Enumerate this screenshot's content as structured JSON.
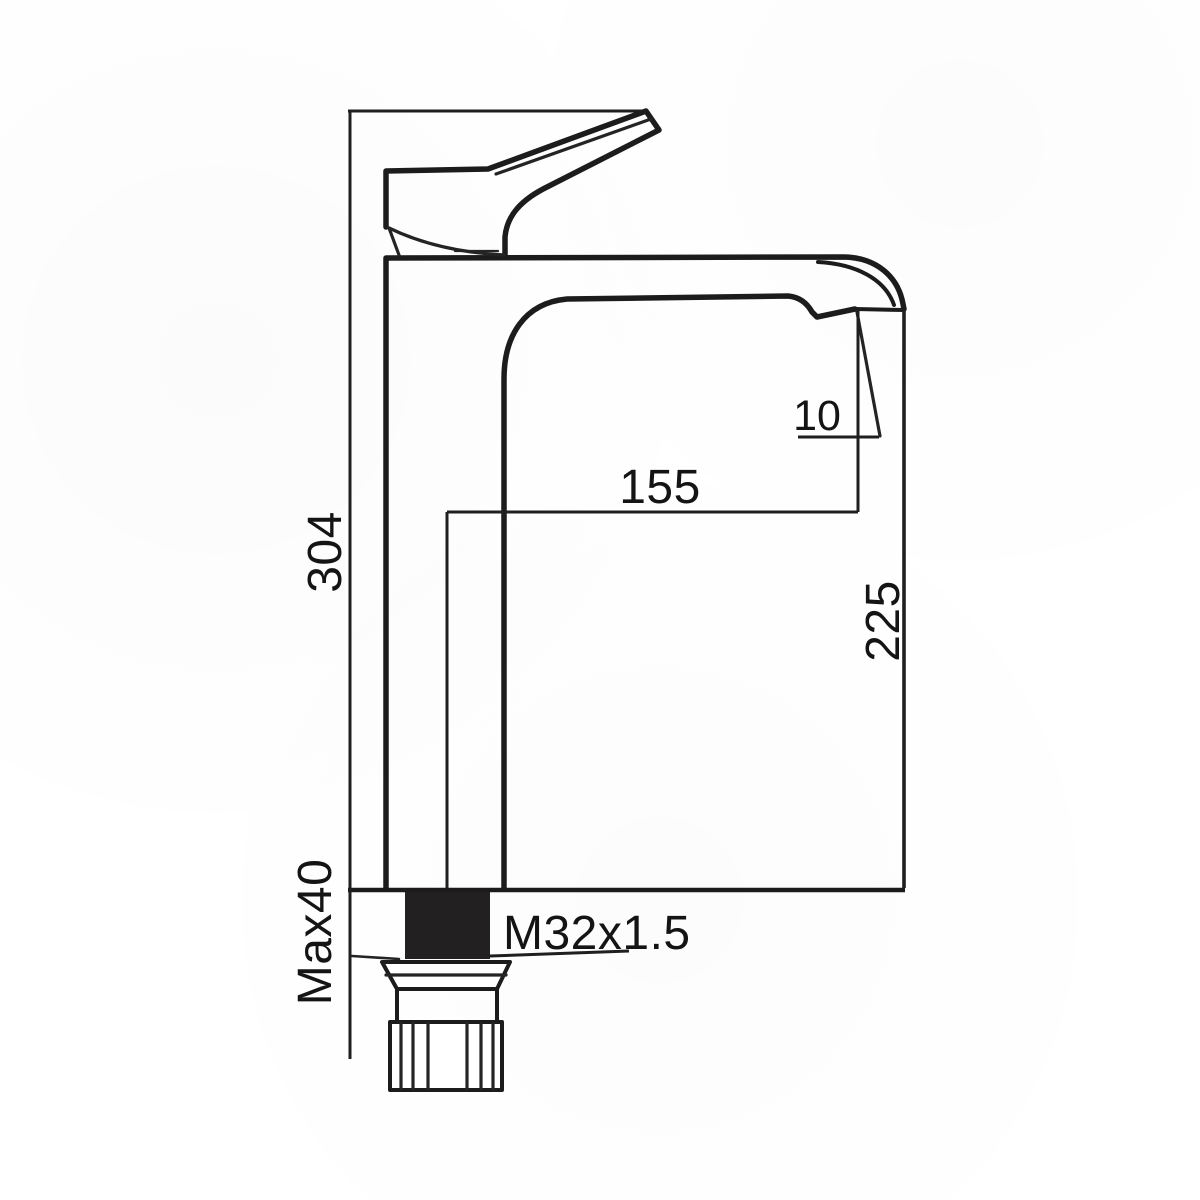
{
  "drawing": {
    "type": "technical-dimension-diagram",
    "subject": "tall single-lever basin mixer tap, side elevation with installation dimensions",
    "colors": {
      "line": "#1c1c1c",
      "background": "#ffffff",
      "thread_fill": "#232021"
    },
    "labels": {
      "overall_height": "304",
      "spout_reach": "155",
      "aerator_angle": "10",
      "spout_height": "225",
      "max_mounting_thickness": "Max40",
      "thread_spec": "M32x1.5"
    }
  }
}
